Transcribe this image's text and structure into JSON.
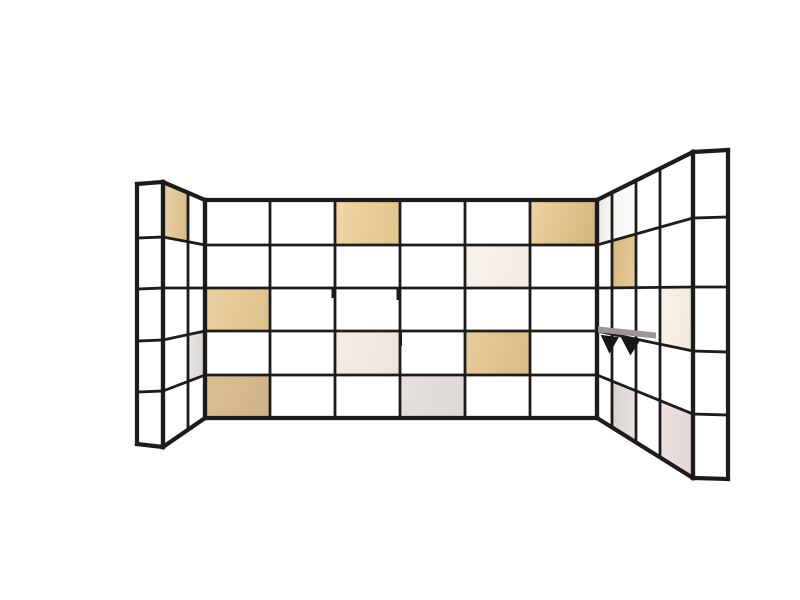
{
  "scene": {
    "description": "3D product render of a U-shaped modular grid shelving room divider with a thin black steel frame; most cells are open, some cells hold plywood, cream, grey and blush panel inserts; two small black cone hooks hang from a shelf on the right wing; plain white background, no visible text",
    "background": "#ffffff",
    "frame_color": "#1c1c1c",
    "inner_line_width": 2.8,
    "outer_line_width": 4.2,
    "canvas": {
      "width": 800,
      "height": 600
    }
  },
  "walls": [
    {
      "id": "left-end-face",
      "xs": [
        137,
        163
      ],
      "rows_start": [
        184,
        238,
        289,
        341,
        392,
        444
      ],
      "rows_end": [
        182,
        237,
        288,
        340,
        391,
        447
      ],
      "panels": []
    },
    {
      "id": "left-wing",
      "xs": [
        163,
        188,
        205
      ],
      "rows_start": [
        182,
        237,
        288,
        340,
        391,
        447
      ],
      "rows_end": [
        200,
        245,
        288,
        331,
        375,
        418
      ],
      "panels": [
        {
          "col": 0,
          "row": 0,
          "material": "plywood",
          "color": "#edd3a3",
          "color2": "#d9bd8b"
        },
        {
          "col": 1,
          "row": 3,
          "material": "grey-laminate",
          "color": "#eae7e5",
          "color2": "#d9d6d4"
        }
      ]
    },
    {
      "id": "center-wall",
      "xs": [
        205,
        270,
        335,
        400,
        465,
        530,
        597
      ],
      "rows_start": [
        200,
        245,
        288,
        331,
        375,
        418
      ],
      "rows_end": [
        200,
        245,
        288,
        331,
        375,
        418
      ],
      "panels": [
        {
          "col": 2,
          "row": 0,
          "material": "plywood",
          "color": "#f1d6a4",
          "color2": "#e3c68e"
        },
        {
          "col": 5,
          "row": 0,
          "material": "plywood",
          "color": "#eed2a0",
          "color2": "#d6b77f"
        },
        {
          "col": 4,
          "row": 1,
          "material": "cream-laminate",
          "color": "#f8f3ec",
          "color2": "#f2ebe1"
        },
        {
          "col": 0,
          "row": 2,
          "material": "plywood",
          "color": "#ebd1a1",
          "color2": "#e0c28c"
        },
        {
          "col": 2,
          "row": 3,
          "material": "cream-laminate",
          "color": "#f4ede5",
          "color2": "#eee6dc"
        },
        {
          "col": 4,
          "row": 3,
          "material": "plywood",
          "color": "#e8cc9b",
          "color2": "#dcbd86"
        },
        {
          "col": 0,
          "row": 4,
          "material": "plywood",
          "color": "#dcc093",
          "color2": "#d0b586"
        },
        {
          "col": 3,
          "row": 4,
          "material": "grey-laminate",
          "color": "#e7e1de",
          "color2": "#e0dad6"
        }
      ]
    },
    {
      "id": "right-wing",
      "xs": [
        597,
        612,
        636,
        660,
        693
      ],
      "rows_start": [
        200,
        245,
        288,
        331,
        375,
        418
      ],
      "rows_end": [
        152,
        218,
        287,
        351,
        414,
        478
      ],
      "panels": [
        {
          "col": 0,
          "row": 0,
          "material": "white-sheen",
          "color": "#e6e4e1",
          "color2": "#faf8f5"
        },
        {
          "col": 1,
          "row": 0,
          "material": "white-sheen",
          "color": "#f5f3f0",
          "color2": "#fcfbf9"
        },
        {
          "col": 1,
          "row": 1,
          "material": "plywood",
          "color": "#d5b880",
          "color2": "#e4c892"
        },
        {
          "col": 3,
          "row": 2,
          "material": "cream-laminate",
          "color": "#f9f3e9",
          "color2": "#f1e9dc"
        },
        {
          "col": 1,
          "row": 4,
          "material": "grey-laminate",
          "color": "#d8d2ce",
          "color2": "#e7e2de"
        },
        {
          "col": 3,
          "row": 4,
          "material": "blush-laminate",
          "color": "#ece1de",
          "color2": "#e4d7d4"
        }
      ]
    },
    {
      "id": "right-end-face",
      "xs": [
        693,
        728
      ],
      "rows_start": [
        152,
        218,
        287,
        351,
        414,
        478
      ],
      "rows_end": [
        150,
        217,
        287,
        352,
        415,
        479
      ],
      "panels": []
    }
  ],
  "accessories": {
    "shelf_lip": {
      "points": [
        [
          598,
          326.5
        ],
        [
          656,
          332.5
        ],
        [
          656,
          338.5
        ],
        [
          598,
          332.5
        ]
      ],
      "color": "#9a9692"
    },
    "hooks": {
      "color": "#161616",
      "items": [
        {
          "points": [
            [
              601.5,
              335.5
            ],
            [
              618,
              337.5
            ],
            [
              609.5,
              352.5
            ]
          ]
        },
        {
          "points": [
            [
              621.5,
              337.5
            ],
            [
              640,
              339.5
            ],
            [
              630.5,
              354.5
            ]
          ]
        }
      ]
    },
    "pegs": {
      "color": "#1c1c1c",
      "width": 3,
      "items": [
        {
          "x": 333,
          "y1": 288.5,
          "y2": 298
        },
        {
          "x": 398,
          "y1": 288.5,
          "y2": 300
        },
        {
          "x": 400.5,
          "y1": 332.5,
          "y2": 346
        }
      ]
    }
  }
}
